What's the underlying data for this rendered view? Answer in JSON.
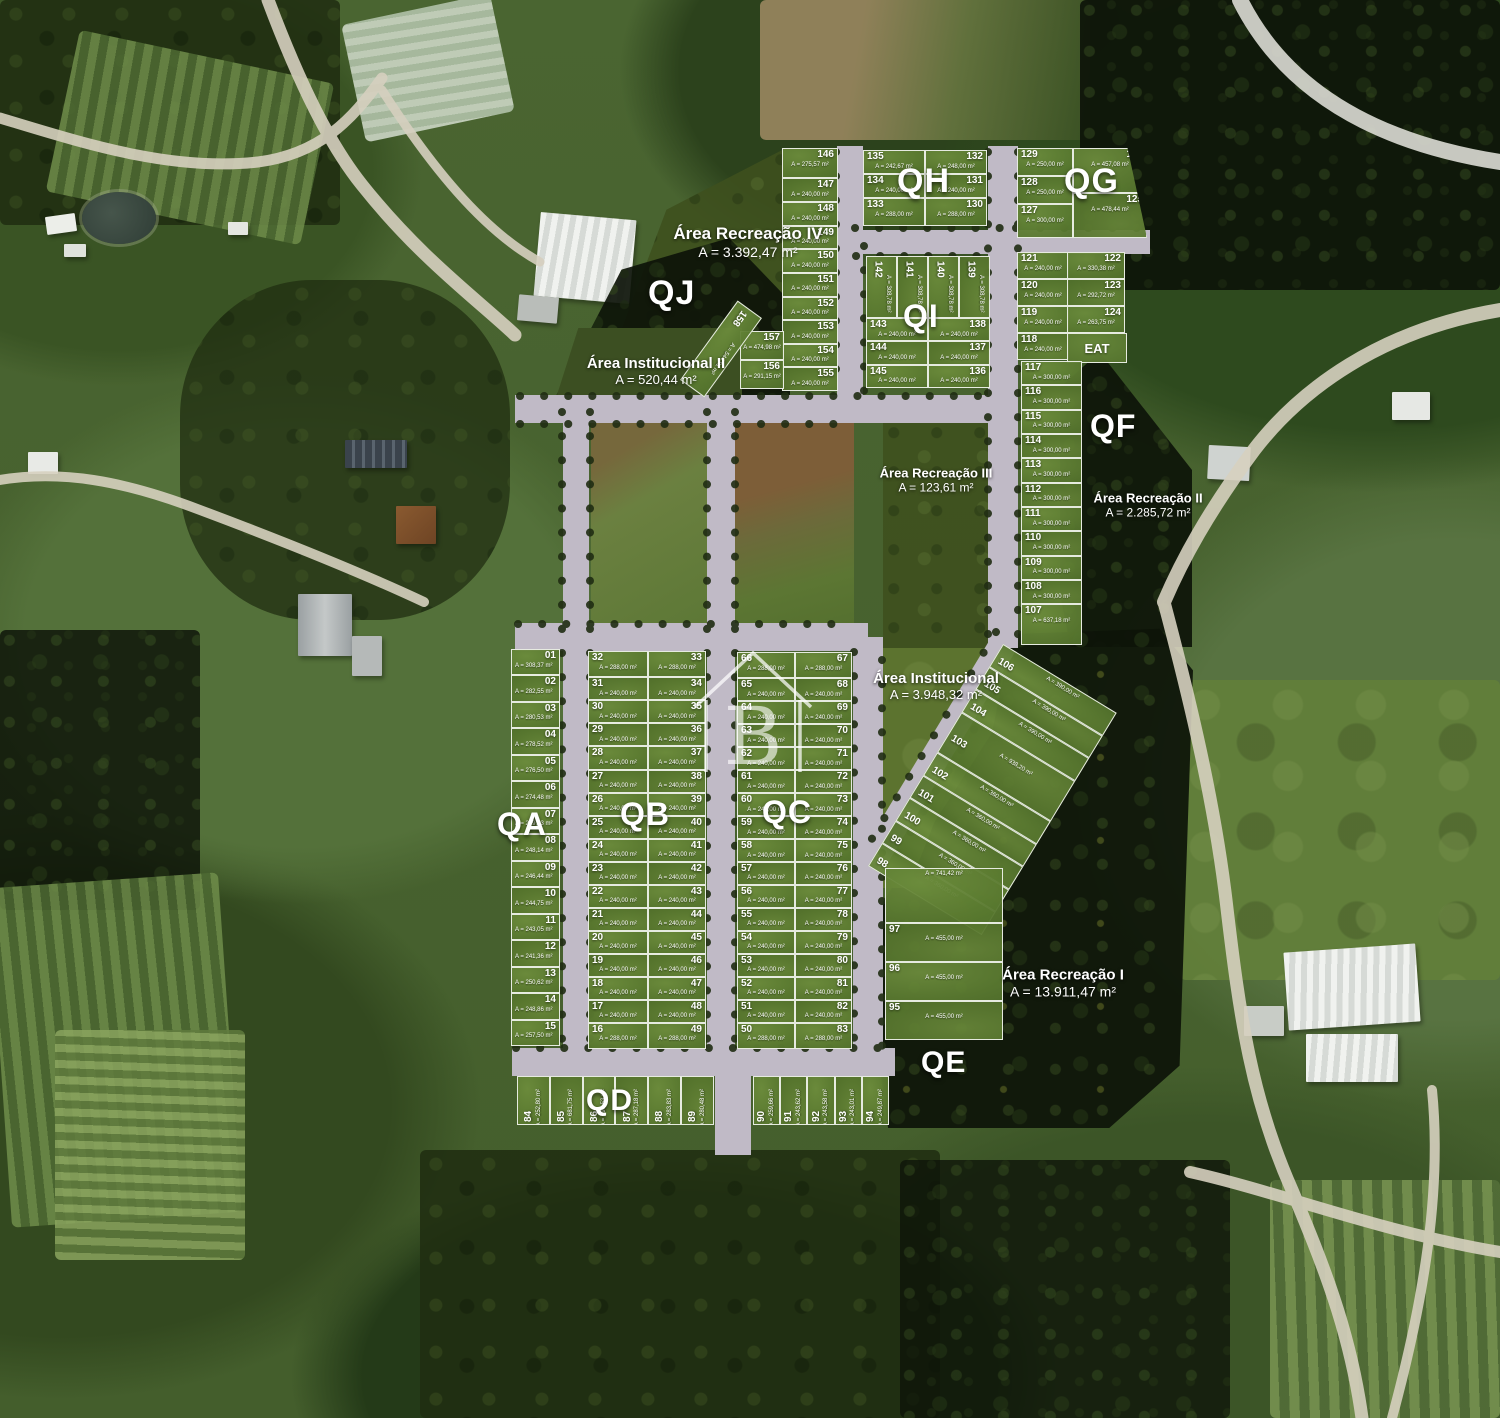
{
  "watermark": {
    "letter": "B"
  },
  "blocks": {
    "qa": "QA",
    "qb": "QB",
    "qc": "QC",
    "qd": "QD",
    "qe": "QE",
    "qf": "QF",
    "qg": "QG",
    "qh": "QH",
    "qi": "QI",
    "qj": "QJ"
  },
  "areas": {
    "recreacao4": {
      "title": "Área Recreação IV",
      "area": "A = 3.392,47 m²"
    },
    "institucional2": {
      "title": "Área Institucional II",
      "area": "A = 520,44 m²"
    },
    "recreacao3": {
      "title": "Área Recreação III",
      "area": "A = 123,61 m²"
    },
    "recreacao2": {
      "title": "Área Recreação II",
      "area": "A = 2.285,72 m²"
    },
    "institucional": {
      "title": "Área Institucional",
      "area": "A = 3.948,32 m²"
    },
    "recreacao1": {
      "title": "Área Recreação I",
      "area": "A = 13.911,47 m²"
    },
    "eat": {
      "title": "EAT"
    }
  },
  "lots": {
    "col146": [
      {
        "n": "146",
        "a": "A = 275,57 m²"
      },
      {
        "n": "147",
        "a": "A = 240,00 m²"
      },
      {
        "n": "148",
        "a": "A = 240,00 m²"
      },
      {
        "n": "149",
        "a": "A = 240,00 m²"
      },
      {
        "n": "150",
        "a": "A = 240,00 m²"
      },
      {
        "n": "151",
        "a": "A = 240,00 m²"
      },
      {
        "n": "152",
        "a": "A = 240,00 m²"
      },
      {
        "n": "153",
        "a": "A = 240,00 m²"
      },
      {
        "n": "154",
        "a": "A = 240,00 m²"
      },
      {
        "n": "155",
        "a": "A = 240,00 m²"
      }
    ],
    "e157": [
      {
        "n": "157",
        "a": "A = 474,98 m²"
      }
    ],
    "e156": [
      {
        "n": "156",
        "a": "A = 291,15 m²"
      }
    ],
    "e158": [
      {
        "n": "158",
        "a": "A = 544,91 m²"
      }
    ],
    "qh_left": [
      {
        "n": "135",
        "a": "A = 242,67 m²"
      },
      {
        "n": "134",
        "a": "A = 240,00 m²"
      },
      {
        "n": "133",
        "a": "A = 288,00 m²"
      }
    ],
    "qh_right": [
      {
        "n": "132",
        "a": "A = 248,00 m²"
      },
      {
        "n": "131",
        "a": "A = 240,00 m²"
      },
      {
        "n": "130",
        "a": "A = 288,00 m²"
      }
    ],
    "qg_left": [
      {
        "n": "129",
        "a": "A = 250,00 m²"
      },
      {
        "n": "128",
        "a": "A = 250,00 m²"
      },
      {
        "n": "127",
        "a": "A = 300,00 m²"
      }
    ],
    "qg_right": [
      {
        "n": "126",
        "a": "A = 457,08 m²"
      },
      {
        "n": "125",
        "a": "A = 478,44 m²"
      }
    ],
    "qi_vert": [
      {
        "n": "142",
        "a": "A = 308,78 m²"
      },
      {
        "n": "141",
        "a": "A = 308,78 m²"
      },
      {
        "n": "140",
        "a": "A = 308,78 m²"
      },
      {
        "n": "139",
        "a": "A = 308,78 m²"
      }
    ],
    "qi_left": [
      {
        "n": "143",
        "a": "A = 240,00 m²"
      },
      {
        "n": "144",
        "a": "A = 240,00 m²"
      },
      {
        "n": "145",
        "a": "A = 240,00 m²"
      }
    ],
    "qi_right": [
      {
        "n": "138",
        "a": "A = 240,00 m²"
      },
      {
        "n": "137",
        "a": "A = 240,00 m²"
      },
      {
        "n": "136",
        "a": "A = 240,00 m²"
      }
    ],
    "qf_ul": [
      {
        "n": "121",
        "a": "A = 240,00 m²"
      },
      {
        "n": "120",
        "a": "A = 240,00 m²"
      },
      {
        "n": "119",
        "a": "A = 240,00 m²"
      },
      {
        "n": "118",
        "a": "A = 240,00 m²"
      }
    ],
    "qf_ur": [
      {
        "n": "122",
        "a": "A = 330,38 m²"
      },
      {
        "n": "123",
        "a": "A = 292,72 m²"
      },
      {
        "n": "124",
        "a": "A = 263,75 m²"
      }
    ],
    "qf_col": [
      {
        "n": "117",
        "a": "A = 300,00 m²"
      },
      {
        "n": "116",
        "a": "A = 300,00 m²"
      },
      {
        "n": "115",
        "a": "A = 300,00 m²"
      },
      {
        "n": "114",
        "a": "A = 300,00 m²"
      },
      {
        "n": "113",
        "a": "A = 300,00 m²"
      },
      {
        "n": "112",
        "a": "A = 300,00 m²"
      },
      {
        "n": "111",
        "a": "A = 300,00 m²"
      },
      {
        "n": "110",
        "a": "A = 300,00 m²"
      },
      {
        "n": "109",
        "a": "A = 300,00 m²"
      },
      {
        "n": "108",
        "a": "A = 300,00 m²"
      },
      {
        "n": "107",
        "a": "A = 637,18 m²"
      }
    ],
    "qa": [
      {
        "n": "01",
        "a": "A = 308,37 m²"
      },
      {
        "n": "02",
        "a": "A = 282,55 m²"
      },
      {
        "n": "03",
        "a": "A = 280,53 m²"
      },
      {
        "n": "04",
        "a": "A = 278,52 m²"
      },
      {
        "n": "05",
        "a": "A = 276,50 m²"
      },
      {
        "n": "06",
        "a": "A = 274,48 m²"
      },
      {
        "n": "07",
        "a": "A = 249,83 m²"
      },
      {
        "n": "08",
        "a": "A = 248,14 m²"
      },
      {
        "n": "09",
        "a": "A = 246,44 m²"
      },
      {
        "n": "10",
        "a": "A = 244,75 m²"
      },
      {
        "n": "11",
        "a": "A = 243,05 m²"
      },
      {
        "n": "12",
        "a": "A = 241,36 m²"
      },
      {
        "n": "13",
        "a": "A = 250,62 m²"
      },
      {
        "n": "14",
        "a": "A = 248,86 m²"
      },
      {
        "n": "15",
        "a": "A = 257,50 m²"
      }
    ],
    "qb_left": [
      {
        "n": "32",
        "a": "A = 288,00 m²"
      },
      {
        "n": "31",
        "a": "A = 240,00 m²"
      },
      {
        "n": "30",
        "a": "A = 240,00 m²"
      },
      {
        "n": "29",
        "a": "A = 240,00 m²"
      },
      {
        "n": "28",
        "a": "A = 240,00 m²"
      },
      {
        "n": "27",
        "a": "A = 240,00 m²"
      },
      {
        "n": "26",
        "a": "A = 240,00 m²"
      },
      {
        "n": "25",
        "a": "A = 240,00 m²"
      },
      {
        "n": "24",
        "a": "A = 240,00 m²"
      },
      {
        "n": "23",
        "a": "A = 240,00 m²"
      },
      {
        "n": "22",
        "a": "A = 240,00 m²"
      },
      {
        "n": "21",
        "a": "A = 240,00 m²"
      },
      {
        "n": "20",
        "a": "A = 240,00 m²"
      },
      {
        "n": "19",
        "a": "A = 240,00 m²"
      },
      {
        "n": "18",
        "a": "A = 240,00 m²"
      },
      {
        "n": "17",
        "a": "A = 240,00 m²"
      },
      {
        "n": "16",
        "a": "A = 288,00 m²"
      }
    ],
    "qb_right": [
      {
        "n": "33",
        "a": "A = 288,00 m²"
      },
      {
        "n": "34",
        "a": "A = 240,00 m²"
      },
      {
        "n": "35",
        "a": "A = 240,00 m²"
      },
      {
        "n": "36",
        "a": "A = 240,00 m²"
      },
      {
        "n": "37",
        "a": "A = 240,00 m²"
      },
      {
        "n": "38",
        "a": "A = 240,00 m²"
      },
      {
        "n": "39",
        "a": "A = 240,00 m²"
      },
      {
        "n": "40",
        "a": "A = 240,00 m²"
      },
      {
        "n": "41",
        "a": "A = 240,00 m²"
      },
      {
        "n": "42",
        "a": "A = 240,00 m²"
      },
      {
        "n": "43",
        "a": "A = 240,00 m²"
      },
      {
        "n": "44",
        "a": "A = 240,00 m²"
      },
      {
        "n": "45",
        "a": "A = 240,00 m²"
      },
      {
        "n": "46",
        "a": "A = 240,00 m²"
      },
      {
        "n": "47",
        "a": "A = 240,00 m²"
      },
      {
        "n": "48",
        "a": "A = 240,00 m²"
      },
      {
        "n": "49",
        "a": "A = 288,00 m²"
      }
    ],
    "qc_left": [
      {
        "n": "66",
        "a": "A = 288,00 m²"
      },
      {
        "n": "65",
        "a": "A = 240,00 m²"
      },
      {
        "n": "64",
        "a": "A = 240,00 m²"
      },
      {
        "n": "63",
        "a": "A = 240,00 m²"
      },
      {
        "n": "62",
        "a": "A = 240,00 m²"
      },
      {
        "n": "61",
        "a": "A = 240,00 m²"
      },
      {
        "n": "60",
        "a": "A = 240,00 m²"
      },
      {
        "n": "59",
        "a": "A = 240,00 m²"
      },
      {
        "n": "58",
        "a": "A = 240,00 m²"
      },
      {
        "n": "57",
        "a": "A = 240,00 m²"
      },
      {
        "n": "56",
        "a": "A = 240,00 m²"
      },
      {
        "n": "55",
        "a": "A = 240,00 m²"
      },
      {
        "n": "54",
        "a": "A = 240,00 m²"
      },
      {
        "n": "53",
        "a": "A = 240,00 m²"
      },
      {
        "n": "52",
        "a": "A = 240,00 m²"
      },
      {
        "n": "51",
        "a": "A = 240,00 m²"
      },
      {
        "n": "50",
        "a": "A = 288,00 m²"
      }
    ],
    "qc_right": [
      {
        "n": "67",
        "a": "A = 288,00 m²"
      },
      {
        "n": "68",
        "a": "A = 240,00 m²"
      },
      {
        "n": "69",
        "a": "A = 240,00 m²"
      },
      {
        "n": "70",
        "a": "A = 240,00 m²"
      },
      {
        "n": "71",
        "a": "A = 240,00 m²"
      },
      {
        "n": "72",
        "a": "A = 240,00 m²"
      },
      {
        "n": "73",
        "a": "A = 240,00 m²"
      },
      {
        "n": "74",
        "a": "A = 240,00 m²"
      },
      {
        "n": "75",
        "a": "A = 240,00 m²"
      },
      {
        "n": "76",
        "a": "A = 240,00 m²"
      },
      {
        "n": "77",
        "a": "A = 240,00 m²"
      },
      {
        "n": "78",
        "a": "A = 240,00 m²"
      },
      {
        "n": "79",
        "a": "A = 240,00 m²"
      },
      {
        "n": "80",
        "a": "A = 240,00 m²"
      },
      {
        "n": "81",
        "a": "A = 240,00 m²"
      },
      {
        "n": "82",
        "a": "A = 240,00 m²"
      },
      {
        "n": "83",
        "a": "A = 288,00 m²"
      }
    ],
    "qd_left": [
      {
        "n": "84",
        "a": "A = 252,80 m²"
      },
      {
        "n": "85",
        "a": "A = 681,75 m²"
      },
      {
        "n": "86",
        "a": "A = 290,53 m²"
      },
      {
        "n": "87",
        "a": "A = 287,18 m²"
      },
      {
        "n": "88",
        "a": "A = 283,83 m²"
      },
      {
        "n": "89",
        "a": "A = 280,48 m²"
      }
    ],
    "qd_right": [
      {
        "n": "90",
        "a": "A = 259,66 m²"
      },
      {
        "n": "91",
        "a": "A = 243,62 m²"
      },
      {
        "n": "92",
        "a": "A = 243,58 m²"
      },
      {
        "n": "93",
        "a": "A = 243,01 m²"
      },
      {
        "n": "94",
        "a": "A = 249,87 m²"
      }
    ],
    "qdiag": [
      {
        "n": "98",
        "a": "A = 360,00 m²"
      },
      {
        "n": "99",
        "a": "A = 360,00 m²"
      },
      {
        "n": "100",
        "a": "A = 360,00 m²"
      },
      {
        "n": "101",
        "a": "A = 360,00 m²"
      },
      {
        "n": "102",
        "a": "A = 360,00 m²"
      },
      {
        "n": "103",
        "a": "A = 938,20 m²"
      },
      {
        "n": "104",
        "a": "A = 390,00 m²"
      },
      {
        "n": "105",
        "a": "A = 390,00 m²"
      },
      {
        "n": "106",
        "a": "A = 390,00 m²"
      }
    ],
    "q95": [
      {
        "n": "",
        "a": "A = 741,42 m²"
      },
      {
        "n": "97",
        "a": "A = 455,00 m²"
      },
      {
        "n": "96",
        "a": "A = 455,00 m²"
      },
      {
        "n": "95",
        "a": "A = 455,00 m²"
      }
    ]
  }
}
